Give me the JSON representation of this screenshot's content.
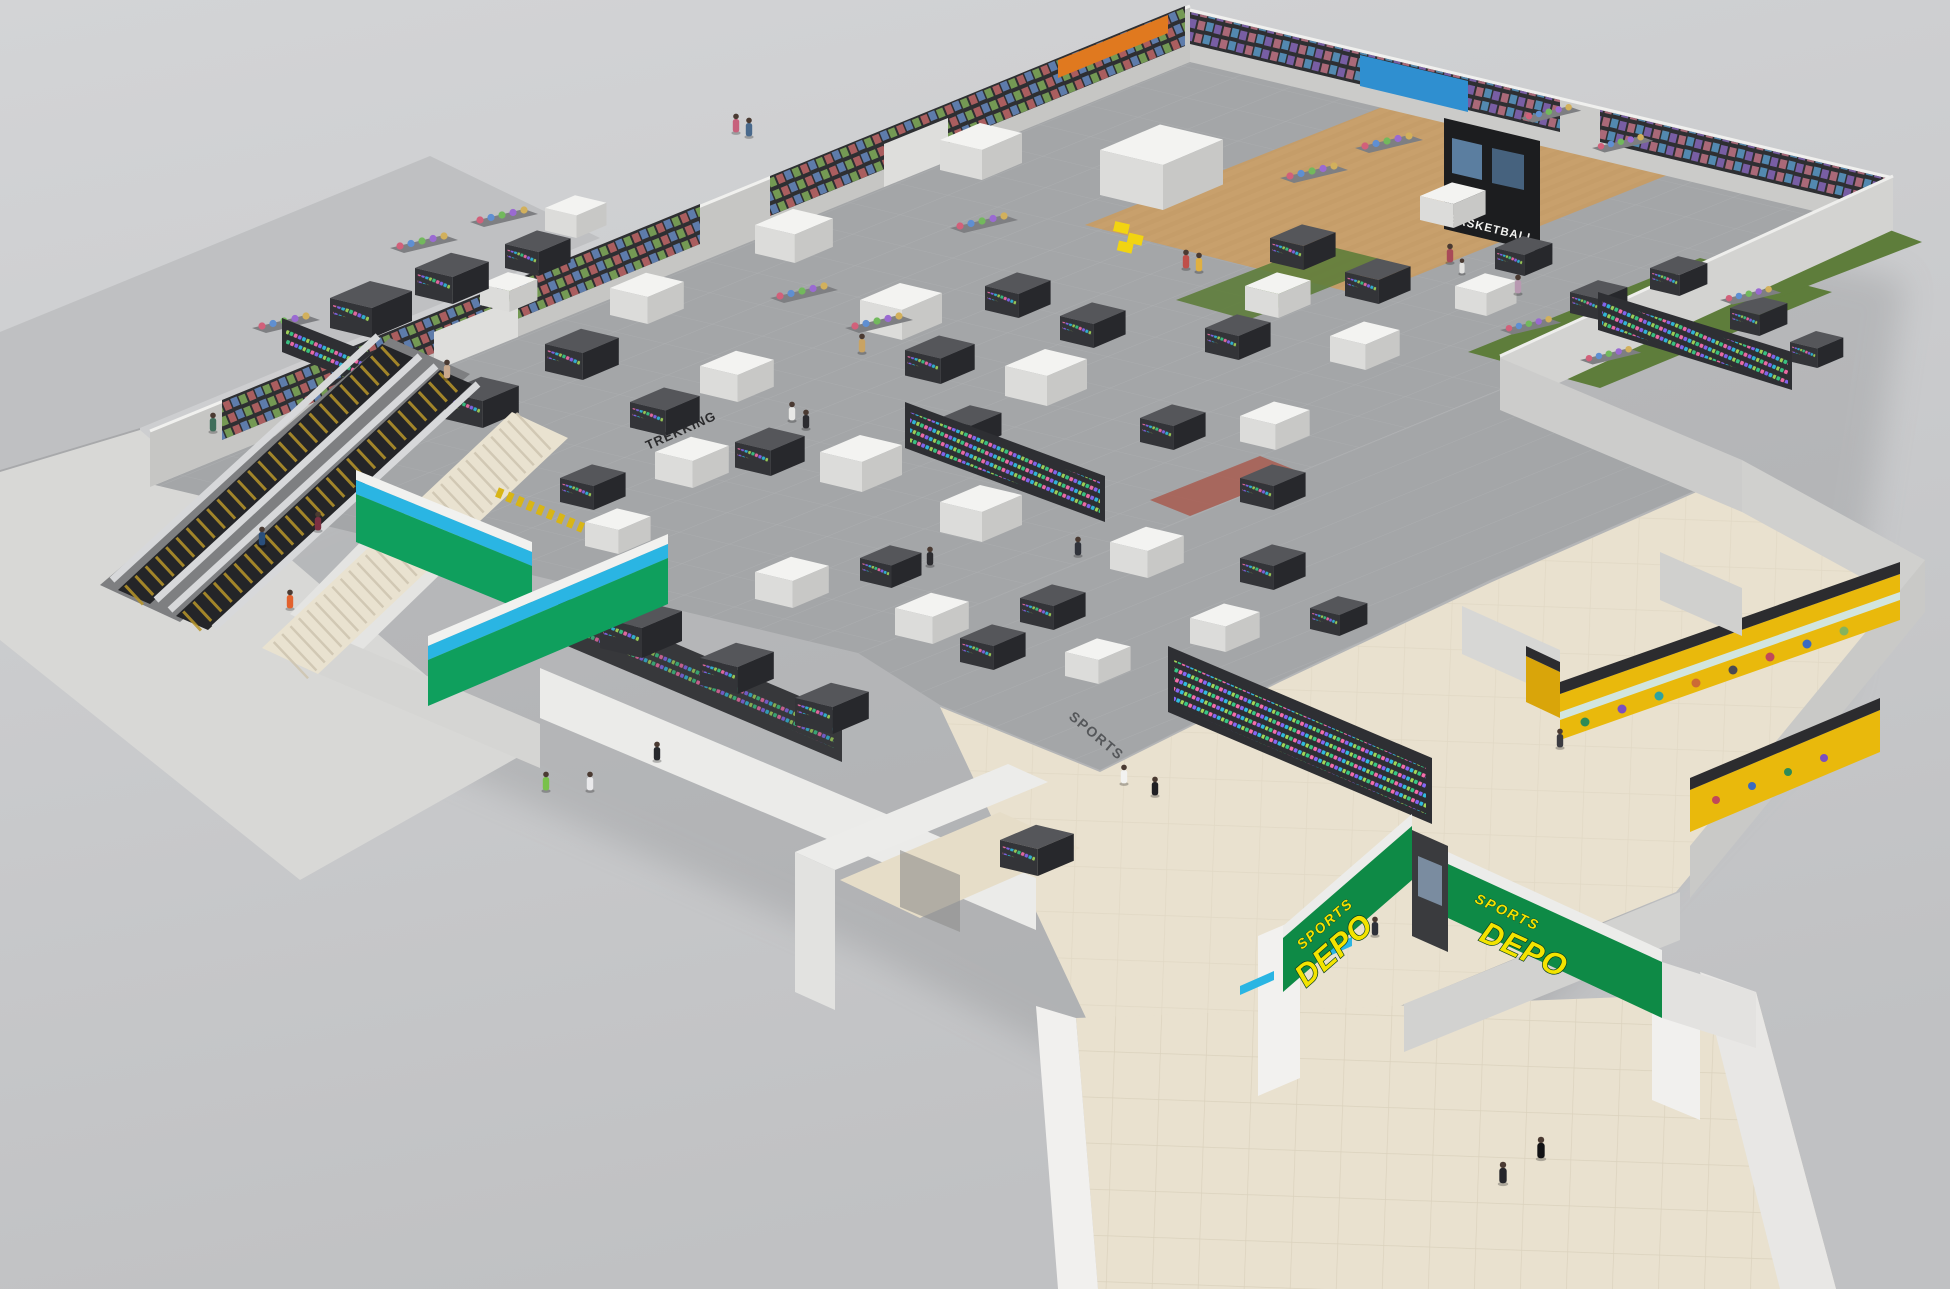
{
  "branding": {
    "store_name": "SPORTS DEPO",
    "sign_left": {
      "top": "SPORTS",
      "main": "DEPO"
    },
    "sign_right": {
      "top": "SPORTS",
      "main": "DEPO"
    },
    "colors": {
      "sign_green": "#0e8a46",
      "sign_text_yellow": "#f3e300",
      "stripe_blue": "#2ab5e3",
      "brand_wall_green": "#0f9f5d"
    }
  },
  "floor_decals": {
    "sports_shoes": "SPORTS SHOES",
    "trekking": "TREKKING"
  },
  "department_signs": {
    "basketball": "BASKETBALL"
  },
  "surfaces": {
    "turf_green": "#5e7d3b",
    "court_wood": "#c8a06c",
    "mall_tile": "#e9e1cf",
    "store_tile": "#a4a6a8"
  }
}
